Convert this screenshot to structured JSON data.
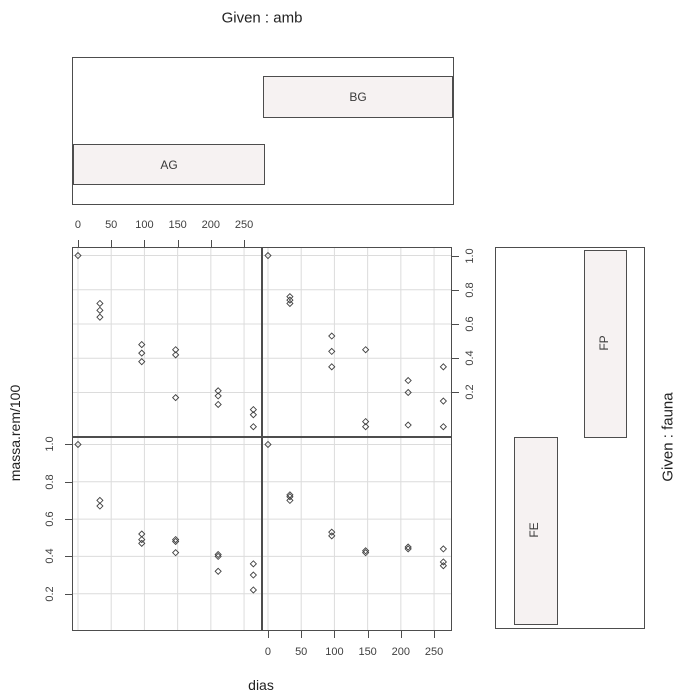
{
  "header": {
    "given_amb_title": "Given : amb"
  },
  "right_strip": {
    "given_fauna_title": "Given : fauna"
  },
  "axes": {
    "x_label": "dias",
    "y_label": "massa.rem/100",
    "x_tick_labels": [
      "0",
      "50",
      "100",
      "150",
      "200",
      "250"
    ],
    "y_tick_labels": [
      "0.2",
      "0.4",
      "0.6",
      "0.8",
      "1.0"
    ]
  },
  "given_amb": {
    "levels": [
      {
        "label": "AG"
      },
      {
        "label": "BG"
      }
    ]
  },
  "given_fauna": {
    "levels": [
      {
        "label": "FE"
      },
      {
        "label": "FP"
      }
    ]
  },
  "colors": {
    "bar_fill": "#f6f2f2",
    "panel_border": "#4d4d4d",
    "grid": "#dcdcdc",
    "point_stroke": "#404040",
    "text": "#333333"
  },
  "chart_data": {
    "type": "scatter",
    "given_titles": [
      "Given : amb",
      "Given : fauna"
    ],
    "xlabel": "dias",
    "ylabel": "massa.rem/100",
    "x_ticks": [
      0,
      50,
      100,
      150,
      200,
      250
    ],
    "y_ticks": [
      0.2,
      0.4,
      0.6,
      0.8,
      1.0
    ],
    "xlim": [
      -9,
      277
    ],
    "ylim": [
      -0.06,
      1.05
    ],
    "grid": true,
    "marker": "open-diamond",
    "panels": [
      {
        "amb": "AG",
        "fauna": "FP",
        "position": "top-left",
        "points": [
          [
            0,
            1.0
          ],
          [
            33,
            0.72
          ],
          [
            33,
            0.68
          ],
          [
            33,
            0.64
          ],
          [
            96,
            0.48
          ],
          [
            96,
            0.43
          ],
          [
            96,
            0.38
          ],
          [
            147,
            0.45
          ],
          [
            147,
            0.42
          ],
          [
            147,
            0.17
          ],
          [
            211,
            0.21
          ],
          [
            211,
            0.18
          ],
          [
            211,
            0.13
          ],
          [
            264,
            0.1
          ],
          [
            264,
            0.07
          ],
          [
            264,
            0.0
          ]
        ]
      },
      {
        "amb": "BG",
        "fauna": "FP",
        "position": "top-right",
        "points": [
          [
            0,
            1.0
          ],
          [
            33,
            0.76
          ],
          [
            33,
            0.74
          ],
          [
            33,
            0.72
          ],
          [
            96,
            0.53
          ],
          [
            96,
            0.44
          ],
          [
            96,
            0.35
          ],
          [
            147,
            0.45
          ],
          [
            147,
            0.03
          ],
          [
            147,
            0.0
          ],
          [
            211,
            0.27
          ],
          [
            211,
            0.2
          ],
          [
            211,
            0.01
          ],
          [
            264,
            0.35
          ],
          [
            264,
            0.15
          ],
          [
            264,
            0.0
          ]
        ]
      },
      {
        "amb": "AG",
        "fauna": "FE",
        "position": "bottom-left",
        "points": [
          [
            0,
            1.0
          ],
          [
            33,
            0.7
          ],
          [
            33,
            0.67
          ],
          [
            96,
            0.52
          ],
          [
            96,
            0.49
          ],
          [
            96,
            0.47
          ],
          [
            147,
            0.49
          ],
          [
            147,
            0.48
          ],
          [
            147,
            0.42
          ],
          [
            211,
            0.41
          ],
          [
            211,
            0.4
          ],
          [
            211,
            0.32
          ],
          [
            264,
            0.36
          ],
          [
            264,
            0.3
          ],
          [
            264,
            0.22
          ]
        ]
      },
      {
        "amb": "BG",
        "fauna": "FE",
        "position": "bottom-right",
        "points": [
          [
            0,
            1.0
          ],
          [
            33,
            0.73
          ],
          [
            33,
            0.72
          ],
          [
            33,
            0.7
          ],
          [
            96,
            0.53
          ],
          [
            96,
            0.51
          ],
          [
            147,
            0.43
          ],
          [
            147,
            0.42
          ],
          [
            211,
            0.45
          ],
          [
            211,
            0.44
          ],
          [
            264,
            0.44
          ],
          [
            264,
            0.37
          ],
          [
            264,
            0.35
          ]
        ]
      }
    ]
  }
}
